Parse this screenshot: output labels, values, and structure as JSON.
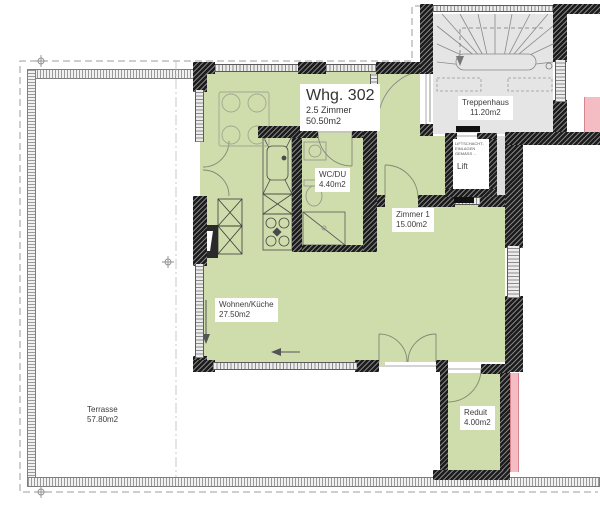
{
  "floorplan": {
    "apartment": {
      "title": "Whg. 302",
      "subtitle": "2.5 Zimmer",
      "area": "50.50m2"
    },
    "rooms": {
      "treppenhaus": {
        "name": "Treppenhaus",
        "area": "11.20m2"
      },
      "lift": {
        "name": "Lift",
        "note": "LIFTSCHACHT- EINLAGEN GEMÄSS ..."
      },
      "wcdu": {
        "name": "WC/DU",
        "area": "4.40m2"
      },
      "zimmer1": {
        "name": "Zimmer 1",
        "area": "15.00m2"
      },
      "wohnen": {
        "name": "Wohnen/Küche",
        "area": "27.50m2"
      },
      "terrasse": {
        "name": "Terrasse",
        "area": "57.80m2"
      },
      "reduit": {
        "name": "Reduit",
        "area": "4.00m2"
      }
    },
    "colors": {
      "apartment_fill": "#cfdcab",
      "stairwell_fill": "#e5e5e5",
      "neighbor_fill": "#f3bdc3",
      "wall": "#1c1c1c",
      "railing": "#9a9a9a"
    }
  }
}
